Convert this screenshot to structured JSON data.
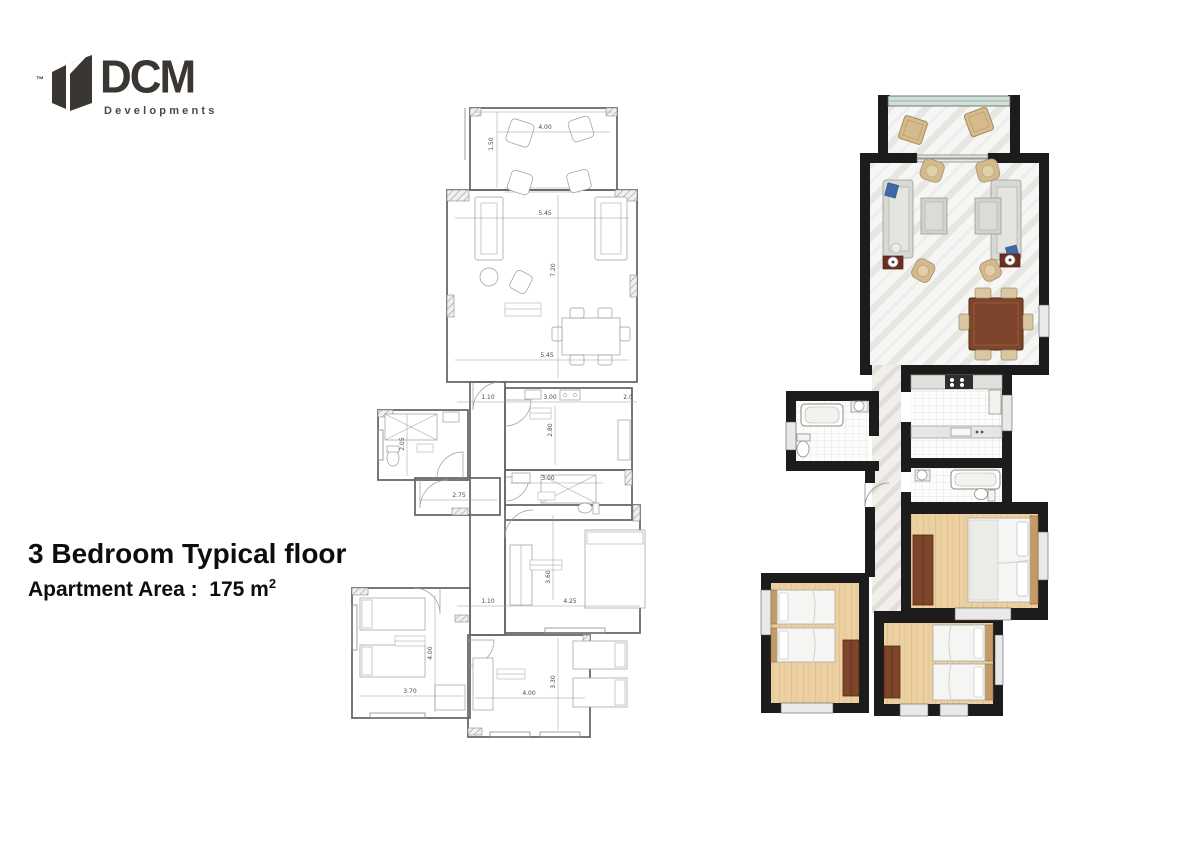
{
  "logo": {
    "tm": "™",
    "name": "DCM",
    "subtitle": "Developments"
  },
  "title": {
    "line1": "3 Bedroom Typical floor",
    "area_label": "Apartment  Area :",
    "area_value": "175 m",
    "area_sup": "2"
  },
  "tech_plan": {
    "dims": {
      "terrace_width": "4.00",
      "terrace_depth": "1.50",
      "living_width_upper": "5.45",
      "living_height": "7.20",
      "living_width_lower": "5.45",
      "hall_width_top": "1.10",
      "kitchen_width": "3.00",
      "kitchen_right": "2.0",
      "kitchen_depth": "2.80",
      "bath1_depth": "2.05",
      "corridor_length": "2.75",
      "bath2_width": "3.00",
      "hall_width_bottom": "1.10",
      "master_width": "4.25",
      "master_depth": "3.60",
      "bedroom2_width": "3.70",
      "bedroom2_depth": "4.00",
      "bedroom3_width": "4.00",
      "bedroom3_depth": "3.30"
    }
  },
  "colors": {
    "wall_black": "#1c1c1c",
    "marble_floor": "#f6f6f4",
    "wood_floor": "#ecd0a2",
    "tile_floor": "#fcfcfc",
    "glass_rail": "#cfe0d8",
    "sofa_gray": "#d8d8d4",
    "pillow_blue": "#3f68a8",
    "chair_tan": "#d5ba8c",
    "table_brown": "#7d452b",
    "lamp_table_maroon": "#6b2e1f",
    "line_gray": "#8a8a8a"
  }
}
